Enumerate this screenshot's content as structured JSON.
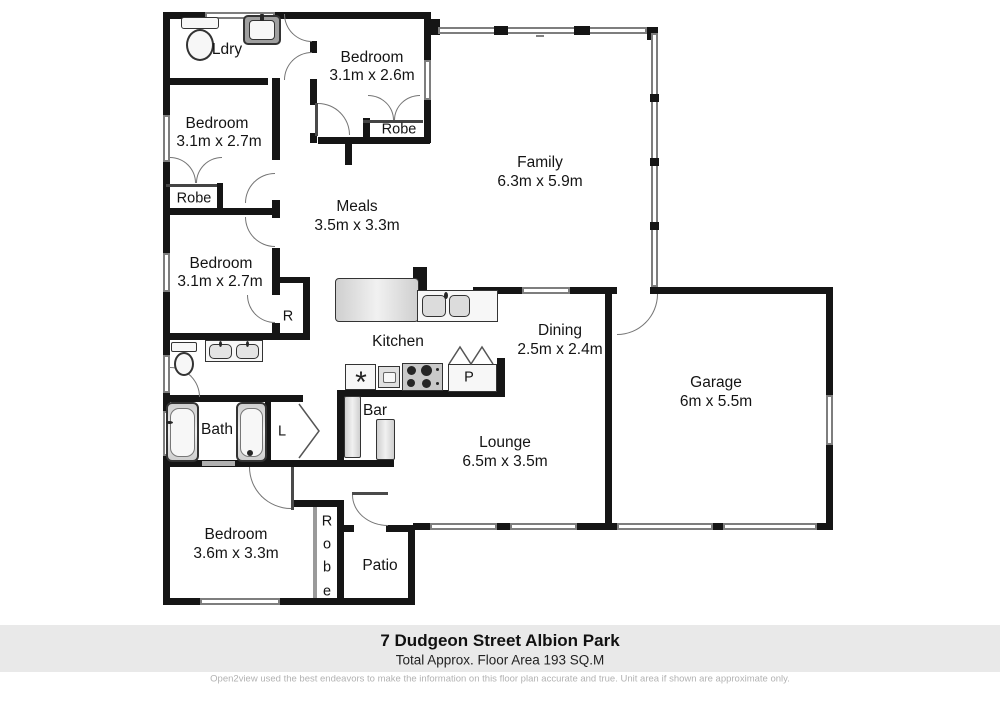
{
  "rooms": {
    "ldry": {
      "name": "Ldry"
    },
    "bed1": {
      "name": "Bedroom",
      "dims": "3.1m x 2.6m"
    },
    "bed2": {
      "name": "Bedroom",
      "dims": "3.1m x 2.7m"
    },
    "bed3": {
      "name": "Bedroom",
      "dims": "3.1m x 2.7m"
    },
    "bed4": {
      "name": "Bedroom",
      "dims": "3.6m x 3.3m"
    },
    "family": {
      "name": "Family",
      "dims": "6.3m x 5.9m"
    },
    "meals": {
      "name": "Meals",
      "dims": "3.5m x 3.3m"
    },
    "kitchen": {
      "name": "Kitchen"
    },
    "dining": {
      "name": "Dining",
      "dims": "2.5m x 2.4m"
    },
    "garage": {
      "name": "Garage",
      "dims": "6m x 5.5m"
    },
    "lounge": {
      "name": "Lounge",
      "dims": "6.5m x 3.5m"
    },
    "bath": {
      "name": "Bath"
    },
    "bar": {
      "name": "Bar"
    },
    "patio": {
      "name": "Patio"
    }
  },
  "closets": {
    "robe_bed1": "Robe",
    "robe_bed2": "Robe",
    "robe_bed4": "Robe",
    "linen": "L",
    "robe_small": "R",
    "pantry": "P"
  },
  "icons": {
    "appliance_asterisk": "*"
  },
  "footer": {
    "address": "7 Dudgeon Street Albion Park",
    "area": "Total Approx. Floor Area 193 SQ.M",
    "disclaimer": "Open2view used the best endeavors to make the information on this floor plan accurate and true. Unit area if shown are approximate only."
  }
}
